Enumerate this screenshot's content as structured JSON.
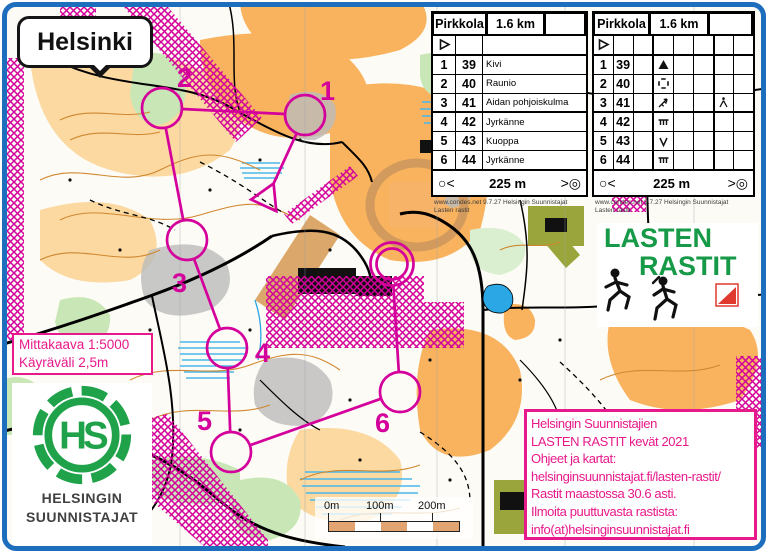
{
  "map_label": {
    "text": "Helsinki"
  },
  "scale_box": {
    "line1": "Mittakaava 1:5000",
    "line2": "Käyräväli 2,5m"
  },
  "course": {
    "name": "Pirkkola",
    "length": "1.6 km",
    "controls": [
      {
        "number": "1",
        "code": "39",
        "description": "Kivi",
        "symbol": "boulder"
      },
      {
        "number": "2",
        "code": "40",
        "description": "Raunio",
        "symbol": "ruin"
      },
      {
        "number": "3",
        "code": "41",
        "description": "Aidan pohjoiskulma",
        "symbol": "fence-corner",
        "extra_symbol": "junction"
      },
      {
        "number": "4",
        "code": "42",
        "description": "Jyrkänne",
        "symbol": "cliff"
      },
      {
        "number": "5",
        "code": "43",
        "description": "Kuoppa",
        "symbol": "pit"
      },
      {
        "number": "6",
        "code": "44",
        "description": "Jyrkänne",
        "symbol": "cliff"
      }
    ],
    "finish_text": "225 m",
    "finish_left_symbol": "○<",
    "finish_right_symbol": ">◎",
    "credits": {
      "line1": "www.condes.net 9.7.27 Helsingin Suunnistajat",
      "line2": "Lasten rastit"
    }
  },
  "lasten_rastit_logo": {
    "line1": "LASTEN",
    "line2": "RASTIT"
  },
  "hs_logo": {
    "monogram": "HS",
    "line1": "HELSINGIN",
    "line2": "SUUNNISTAJAT"
  },
  "info_box": {
    "lines": [
      "Helsingin Suunnistajien",
      "LASTEN RASTIT kevät 2021",
      "Ohjeet ja kartat:",
      "helsinginsuunnistajat.fi/lasten-rastit/",
      "Rastit maastossa 30.6 asti.",
      "Ilmoita puuttuvasta rastista:",
      "info(at)helsinginsuunnistajat.fi"
    ]
  },
  "scale_bar": {
    "labels": [
      "0m",
      "100m",
      "200m"
    ]
  },
  "colors": {
    "course_magenta": "#d4009b",
    "info_pink": "#e8198b",
    "logo_green": "#169a47",
    "frame_blue": "#1d6fbe"
  }
}
